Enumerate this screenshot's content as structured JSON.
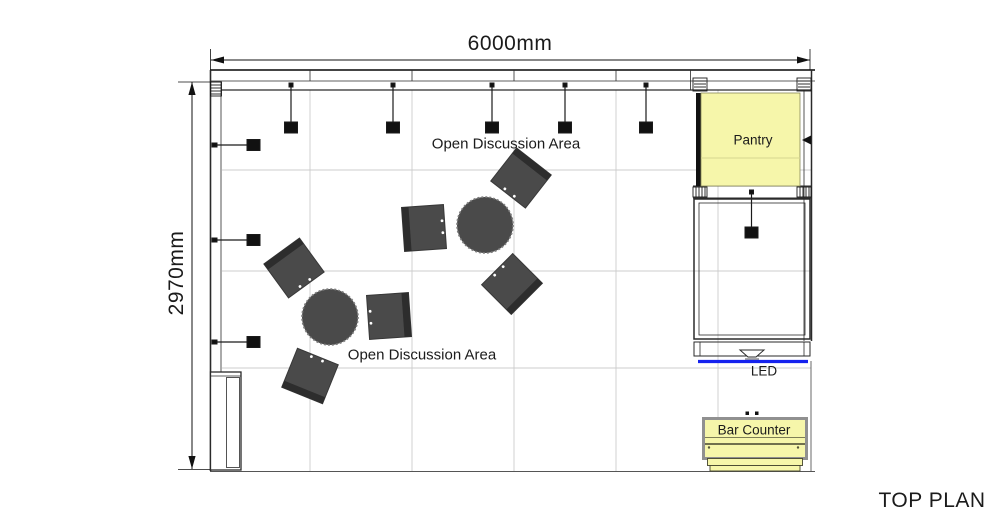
{
  "drawing": {
    "title": "TOP PLAN",
    "dimension_width": "6000mm",
    "dimension_height": "2970mm"
  },
  "areas": {
    "open_discussion_top": "Open Discussion Area",
    "open_discussion_bottom": "Open Discussion Area",
    "pantry": "Pantry",
    "led": "LED",
    "bar_counter": "Bar Counter"
  },
  "furniture": {
    "round_tables": 2,
    "chairs": 6,
    "ceiling_lights_top": 5,
    "wall_lights_left": 3,
    "light_below_pantry": 1
  },
  "colors": {
    "highlight_yellow": "#f6f6aa",
    "led_blue": "#1522ee",
    "furniture_gray": "#4a4a4a",
    "backrest_gray": "#2d2d2d",
    "grid_gray": "#cccccc",
    "line_black": "#1a1a1a",
    "counter_shadow_gray": "#909090"
  }
}
